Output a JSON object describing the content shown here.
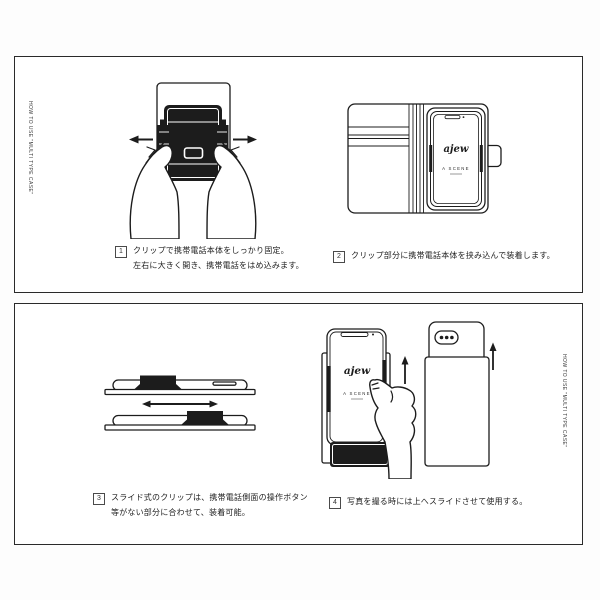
{
  "side_label": "HOW TO USE \"MULTI TYPE CASE\"",
  "steps": [
    {
      "num": "1",
      "line1": "クリップで携帯電話本体をしっかり固定。",
      "line2": "左右に大きく開き、携帯電話をはめ込みます。"
    },
    {
      "num": "2",
      "line1": "クリップ部分に携帯電話本体を挟み込んで装着します。",
      "line2": ""
    },
    {
      "num": "3",
      "line1": "スライド式のクリップは、携帯電話側面の操作ボタン",
      "line2": "等がない部分に合わせて、装着可能。"
    },
    {
      "num": "4",
      "line1": "写真を撮る時には上へスライドさせて使用する。",
      "line2": ""
    }
  ],
  "phone_screen": {
    "brand": "ajew",
    "collection": "A SCENE"
  },
  "illustrations": {
    "step1": "hands-opening-clip-back-view",
    "step2": "open-folio-case-with-phone",
    "step3": "slide-clip-side-views",
    "step4": "slide-phone-up-for-camera"
  },
  "colors": {
    "ink": "#1c1c1c",
    "panel_border": "#2a2a2a",
    "background": "#ffffff"
  }
}
